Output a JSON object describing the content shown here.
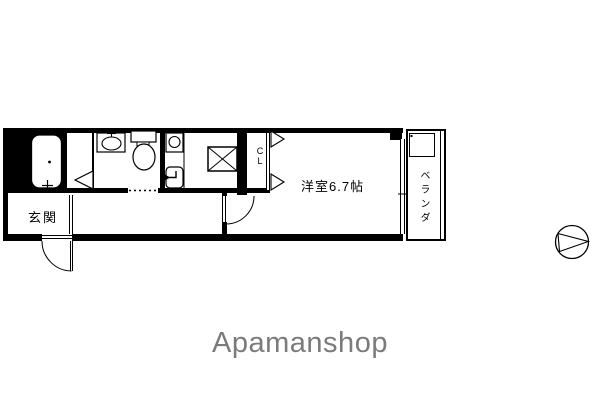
{
  "labels": {
    "entrance": "玄関",
    "room": "洋室6.7帖",
    "closet_top": "C",
    "closet_bottom": "L",
    "balcony": "ベランダ",
    "brand": "Apamanshop"
  },
  "fixtures": {
    "bathtub": "bathtub",
    "washbasin": "washbasin",
    "toilet": "toilet",
    "washing_machine_pan": "washing-machine-pan",
    "laundry_faucet": "laundry-faucet",
    "kitchen_unit": "kitchen-range-box",
    "compass": "north-compass"
  },
  "colors": {
    "walls": "#000000",
    "brand": "#7b7b7b",
    "background": "#ffffff"
  }
}
